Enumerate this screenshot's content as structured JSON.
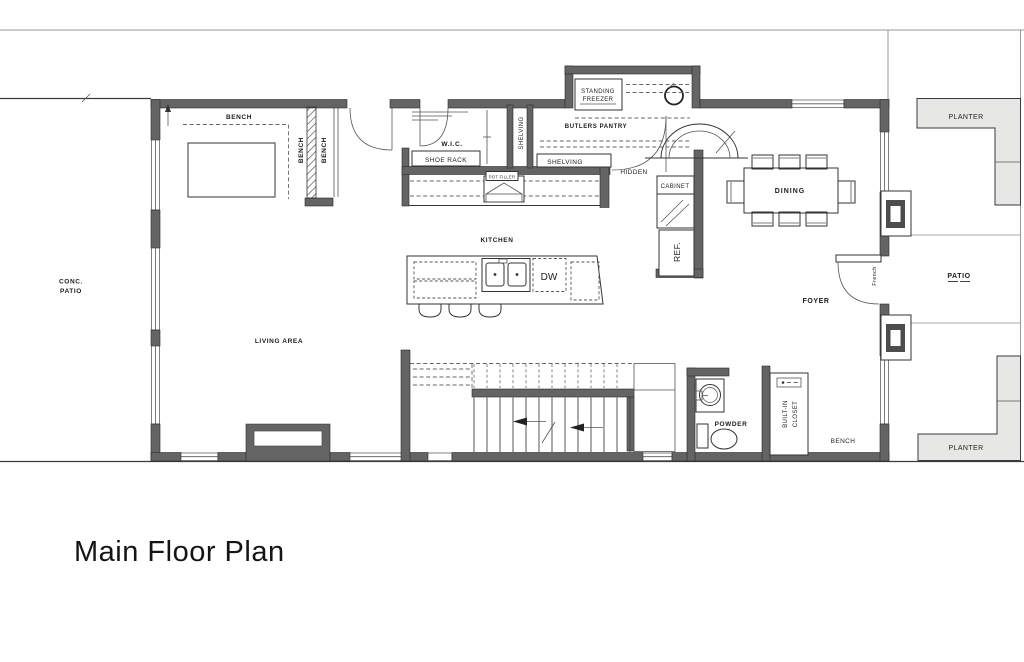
{
  "title": "Main Floor Plan",
  "colors": {
    "wall": "#646464",
    "planter": "#e7e7e5",
    "line": "#222222"
  },
  "labels": {
    "conc_patio_1": "CONC.",
    "conc_patio_2": "PATIO",
    "bench_top": "BENCH",
    "bench_v1": "BENCH",
    "bench_v2": "BENCH",
    "wic": "W.I.C.",
    "shoe_rack": "SHOE RACK",
    "shelving_v": "SHELVING",
    "shelving_h": "SHELVING",
    "standing_freezer_1": "STANDING",
    "standing_freezer_2": "FREEZER",
    "butlers_pantry": "BUTLERS PANTRY",
    "hidden": "HIDDEN",
    "cabinet": "CABINET",
    "ref": "REF.",
    "kitchen": "KITCHEN",
    "pot_filler": "POT FILLER",
    "dw": "DW",
    "dining": "DINING",
    "foyer": "FOYER",
    "french": "French",
    "patio": "PATIO",
    "planter_top": "PLANTER",
    "planter_bottom": "PLANTER",
    "living_area": "LIVING AREA",
    "powder": "POWDER",
    "built_in_1": "BUILT-IN",
    "built_in_2": "CLOSET",
    "bench_bottom": "BENCH"
  }
}
